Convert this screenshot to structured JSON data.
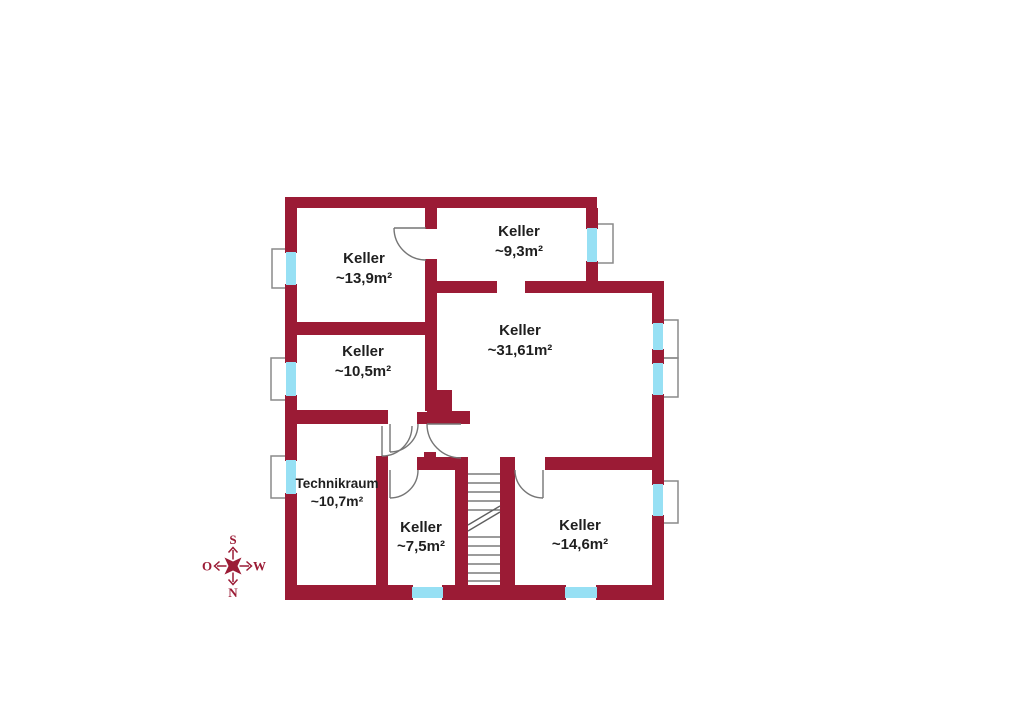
{
  "colors": {
    "wall": "#9b1b35",
    "window": "#97e0f4",
    "shaft": "#8a8a8a",
    "door": "#757575",
    "stair": "#5f5f5f",
    "label": "#1f1f1f",
    "background": "#ffffff"
  },
  "rooms": [
    {
      "name": "Keller",
      "area": "~13,9m²"
    },
    {
      "name": "Keller",
      "area": "~9,3m²"
    },
    {
      "name": "Keller",
      "area": "~31,61m²"
    },
    {
      "name": "Keller",
      "area": "~10,5m²"
    },
    {
      "name": "Technikraum",
      "area": "~10,7m²"
    },
    {
      "name": "Keller",
      "area": "~7,5m²"
    },
    {
      "name": "Keller",
      "area": "~14,6m²"
    }
  ],
  "compass": {
    "top": "S",
    "bottom": "N",
    "left": "O",
    "right": "W"
  }
}
